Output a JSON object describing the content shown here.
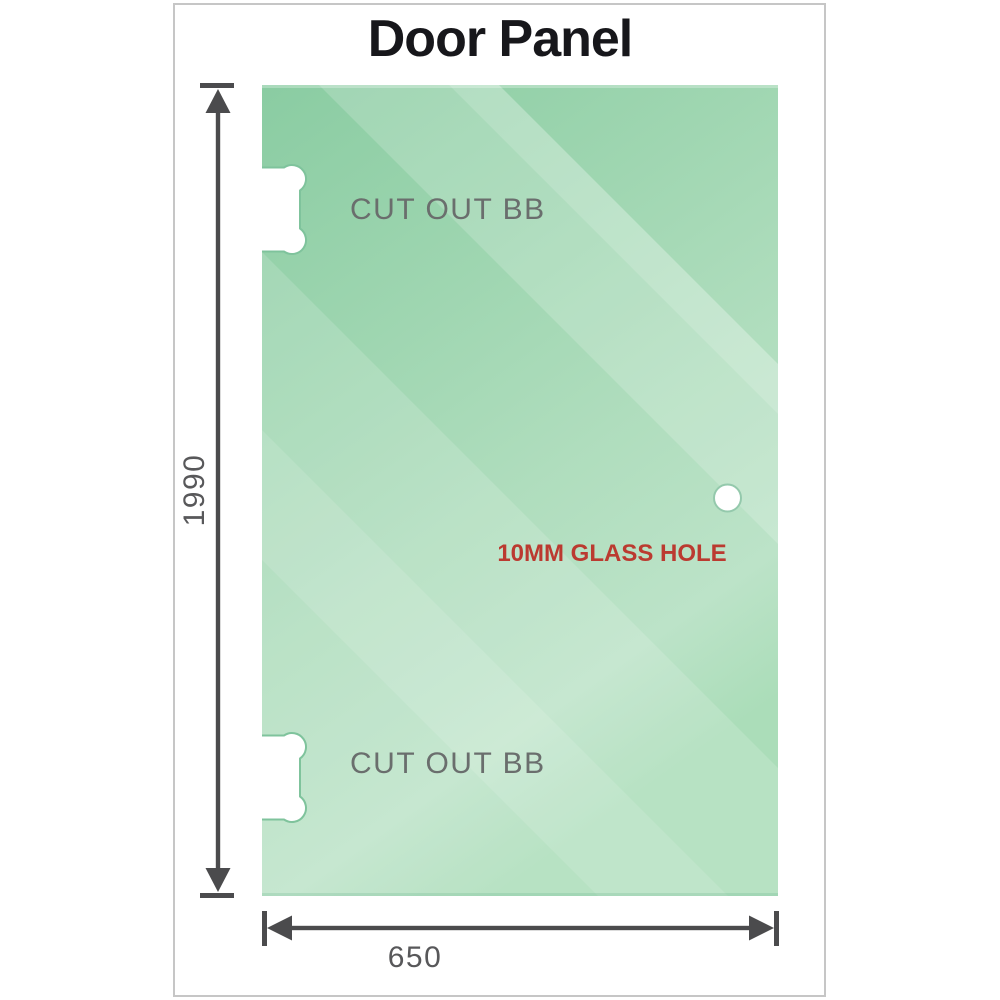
{
  "title": "Door Panel",
  "panel": {
    "cutouts": [
      {
        "label": "CUT OUT BB"
      },
      {
        "label": "CUT OUT BB"
      }
    ],
    "hole_label": "10MM GLASS HOLE"
  },
  "dimensions": {
    "height": "1990",
    "width": "650"
  },
  "colors": {
    "glass_base_dark": "#8acca2",
    "glass_base_light": "#bce3c8",
    "glass_reflection": "#ffffff",
    "cutout_fill": "#ffffff",
    "cutout_rim": "#7fc39c",
    "hole_rim": "#94c9ac",
    "dimension_line": "#4b4b4d",
    "dimension_text": "#58585a",
    "cutout_text": "#6a6e6d",
    "hole_text": "#bb3a30",
    "title_text": "#17171b",
    "frame_border": "#c6c6c6"
  }
}
